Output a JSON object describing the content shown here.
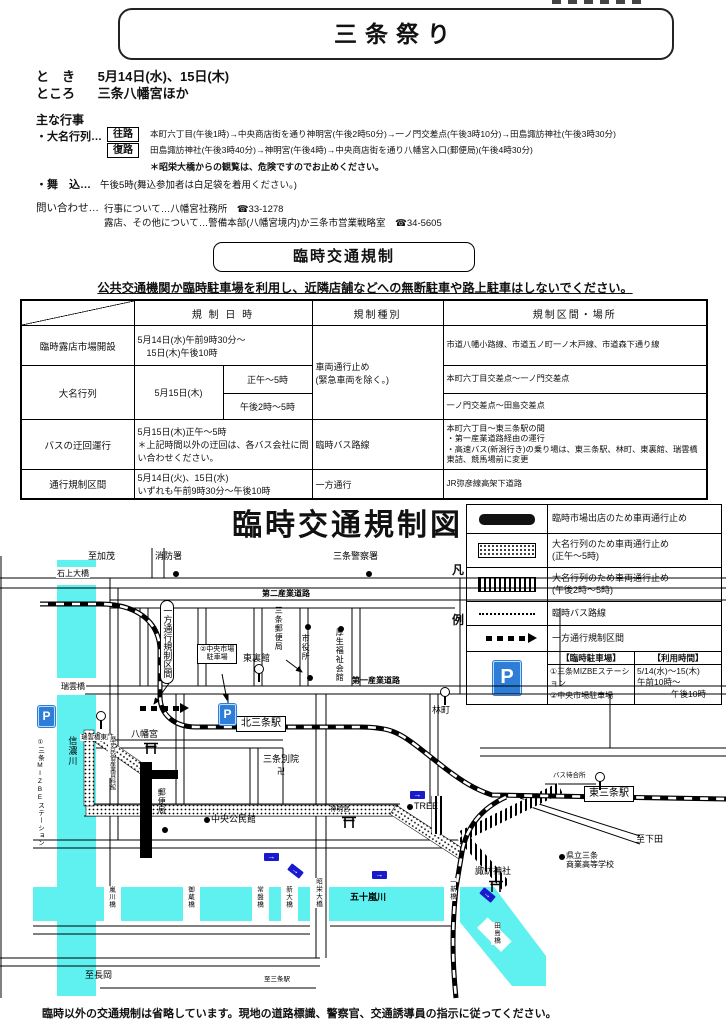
{
  "header": {
    "title": "三条祭り",
    "when_label": "と　き",
    "when": "5月14日(水)、15日(木)",
    "where_label": "ところ",
    "where": "三条八幡宮ほか"
  },
  "events": {
    "heading": "主な行事",
    "daimyo_label": "・大名行列…",
    "outbound_tag": "往路",
    "outbound": "本町六丁目(午後1時)→中央商店街を通り神明宮(午後2時50分)→一ノ門交差点(午後3時10分)→田島諏訪神社(午後3時30分)",
    "return_tag": "復路",
    "return": "田島諏訪神社(午後3時40分)→神明宮(午後4時)→中央商店街を通り八幡宮入口(郵便局)(午後4時30分)",
    "note": "＊昭栄大橋からの観覧は、危険ですのでお止めください。",
    "maikomi_label": "・舞　込…",
    "maikomi": "午後5時(舞込参加者は白足袋を着用ください。)",
    "contact_label": "問い合わせ…",
    "contact1": "行事について…八幡宮社務所　☎33-1278",
    "contact2": "露店、その他について…警備本部(八幡宮境内)か三条市営業戦略室　☎34-5605"
  },
  "regulation": {
    "heading": "臨時交通規制",
    "notice": "公共交通機関か臨時駐車場を利用し、近隣店舗などへの無断駐車や路上駐車はしないでください。",
    "table": {
      "col_datetime": "規 制 日 時",
      "col_type": "規制種別",
      "col_area": "規制区間・場所",
      "rows": {
        "market": {
          "name": "臨時露店市場開設",
          "datetime": "5月14日(水)午前9時30分～\n　15日(木)午後10時",
          "type": "車両通行止め\n(緊急車両を除く。)",
          "area": "市道八幡小路線、市道五ノ町一ノ木戸線、市道森下通り線"
        },
        "parade": {
          "name": "大名行列",
          "date": "5月15日(木)",
          "time1": "正午～5時",
          "area1": "本町六丁目交差点～一ノ門交差点",
          "time2": "午後2時～5時",
          "area2": "一ノ門交差点～田島交差点"
        },
        "bus": {
          "name": "バスの迂回運行",
          "datetime": "5月15日(木)正午～5時\n＊上記時間以外の迂回は、各バス会社に問い合わせください。",
          "type": "臨時バス路線",
          "area": "本町六丁目～東三条駅の間\n・第一産業道路経由の運行\n・高速バス(新潟行き)の乗り場は、東三条駅、林町、東裏館、瑞雲橋東詰、競馬場前に変更"
        },
        "oneway": {
          "name": "通行規制区間",
          "datetime": "5月14日(火)、15日(水)\nいずれも午前9時30分～午後10時",
          "type": "一方通行",
          "area": "JR弥彦線高架下道路"
        }
      }
    }
  },
  "map": {
    "title": "臨時交通規制図",
    "note": "臨時以外の交通規制は省略しています。現地の道路標識、警察官、交通誘導員の指示に従ってください。",
    "legend": {
      "caption_top": "凡",
      "caption_bottom": "例",
      "items": [
        {
          "swatch": "solid",
          "text": "臨時市場出店のため車両通行止め"
        },
        {
          "swatch": "dots",
          "text": "大名行列のため車両通行止め\n(正午～5時)"
        },
        {
          "swatch": "stripes",
          "text": "大名行列のため車両通行止め\n(午後2時～5時)"
        },
        {
          "swatch": "dotline",
          "text": "臨時バス路線"
        },
        {
          "swatch": "dash",
          "text": "一方通行規制区間"
        }
      ],
      "parking": {
        "icon": "P",
        "col1_header": "【臨時駐車場】",
        "col2_header": "【利用時間】",
        "col1_lines": "①三条MIZBEステーション\n②中央市場駐車場",
        "col2_lines": "5/14(水)～15(木)\n午前10時～\n　　　　午後10時"
      }
    },
    "labels": [
      {
        "t": "至加茂",
        "x": 88,
        "y": 3
      },
      {
        "t": "消防署",
        "x": 155,
        "y": 3
      },
      {
        "t": "三条警察署",
        "x": 333,
        "y": 3
      },
      {
        "t": "石上大橋",
        "x": 56,
        "y": 21,
        "c": "wbg sm"
      },
      {
        "t": "第二産業道路",
        "x": 262,
        "y": 41,
        "c": "sm b"
      },
      {
        "t": "第一産業道路",
        "x": 352,
        "y": 128,
        "c": "sm b"
      },
      {
        "t": "一方通行規制区間",
        "x": 160,
        "y": 52,
        "c": "vround"
      },
      {
        "t": "三条郵便局",
        "x": 274,
        "y": 58,
        "c": "v sm"
      },
      {
        "t": "市役所",
        "x": 301,
        "y": 86,
        "c": "v sm"
      },
      {
        "t": "厚生福祉会館",
        "x": 335,
        "y": 80,
        "c": "v sm"
      },
      {
        "t": "②中央市場\n駐車場",
        "x": 197,
        "y": 96,
        "c": "boxsm"
      },
      {
        "t": "東裏館",
        "x": 243,
        "y": 105
      },
      {
        "t": "林町",
        "x": 432,
        "y": 157
      },
      {
        "t": "瑞雲橋",
        "x": 60,
        "y": 134,
        "c": "wbg sm"
      },
      {
        "t": "瑞雲橋東詰",
        "x": 80,
        "y": 186,
        "c": "tiny wbg"
      },
      {
        "t": "八幡宮",
        "x": 131,
        "y": 181
      },
      {
        "t": "歴史民俗産業資料館",
        "x": 108,
        "y": 188,
        "c": "vtiny"
      },
      {
        "t": "北三条駅",
        "x": 236,
        "y": 168,
        "c": "box"
      },
      {
        "t": "三条別院",
        "x": 263,
        "y": 206
      },
      {
        "t": "卍",
        "x": 277,
        "y": 219,
        "c": "sm"
      },
      {
        "t": "郵便局",
        "x": 157,
        "y": 240,
        "c": "v sm"
      },
      {
        "t": "中央公民館",
        "x": 211,
        "y": 266
      },
      {
        "t": "TREE",
        "x": 414,
        "y": 253
      },
      {
        "t": "神明宮",
        "x": 330,
        "y": 258,
        "c": "tiny"
      },
      {
        "t": "バス待合所",
        "x": 553,
        "y": 224,
        "c": "tiny"
      },
      {
        "t": "東三条駅",
        "x": 584,
        "y": 238,
        "c": "box"
      },
      {
        "t": "至下田",
        "x": 636,
        "y": 286
      },
      {
        "t": "県立三条\n商業高等学校",
        "x": 566,
        "y": 303,
        "c": "sm"
      },
      {
        "t": "諏訪神社",
        "x": 475,
        "y": 318
      },
      {
        "t": "一新橋",
        "x": 447,
        "y": 330,
        "c": "v tiny wbg"
      },
      {
        "t": "田島橋",
        "x": 491,
        "y": 374,
        "c": "v tiny wbg"
      },
      {
        "t": "嵐川橋",
        "x": 106,
        "y": 338,
        "c": "v tiny wbg"
      },
      {
        "t": "御蔵橋",
        "x": 185,
        "y": 338,
        "c": "v tiny wbg"
      },
      {
        "t": "常盤橋",
        "x": 254,
        "y": 338,
        "c": "v tiny wbg"
      },
      {
        "t": "新大橋",
        "x": 283,
        "y": 338,
        "c": "v tiny wbg"
      },
      {
        "t": "昭栄大橋",
        "x": 313,
        "y": 330,
        "c": "v tiny wbg"
      },
      {
        "t": "五十嵐川",
        "x": 350,
        "y": 344,
        "c": "b"
      },
      {
        "t": "信濃川",
        "x": 67,
        "y": 188,
        "c": "v"
      },
      {
        "t": "①三条MIZBEステーション",
        "x": 36,
        "y": 190,
        "c": "v tiny"
      },
      {
        "t": "至長岡",
        "x": 85,
        "y": 422
      },
      {
        "t": "至三条駅",
        "x": 264,
        "y": 428,
        "c": "tiny"
      }
    ],
    "markers": [
      {
        "type": "dot",
        "x": 173,
        "y": 23
      },
      {
        "type": "dot",
        "x": 366,
        "y": 23
      },
      {
        "type": "dot",
        "x": 305,
        "y": 76
      },
      {
        "type": "dot",
        "x": 307,
        "y": 127
      },
      {
        "type": "dot",
        "x": 338,
        "y": 78
      },
      {
        "type": "dot",
        "x": 162,
        "y": 279
      },
      {
        "type": "dot",
        "x": 204,
        "y": 269
      },
      {
        "type": "dot",
        "x": 407,
        "y": 256
      },
      {
        "type": "dot",
        "x": 559,
        "y": 306
      },
      {
        "type": "busstop",
        "x": 254,
        "y": 116
      },
      {
        "type": "busstop",
        "x": 440,
        "y": 139
      },
      {
        "type": "busstop",
        "x": 96,
        "y": 163
      },
      {
        "type": "busstop",
        "x": 595,
        "y": 224
      },
      {
        "type": "torii",
        "x": 143,
        "y": 193
      },
      {
        "type": "torii",
        "x": 488,
        "y": 331
      },
      {
        "type": "torii",
        "x": 341,
        "y": 267
      },
      {
        "type": "parking",
        "x": 38,
        "y": 158
      },
      {
        "type": "parking",
        "x": 219,
        "y": 156
      },
      {
        "type": "bluearrow",
        "x": 264,
        "y": 305,
        "r": 0
      },
      {
        "type": "bluearrow",
        "x": 288,
        "y": 319,
        "r": 38
      },
      {
        "type": "bluearrow",
        "x": 372,
        "y": 323,
        "r": 0
      },
      {
        "type": "bluearrow",
        "x": 410,
        "y": 243,
        "r": 0
      },
      {
        "type": "bluearrow",
        "x": 480,
        "y": 343,
        "r": 40
      },
      {
        "type": "dasharrow",
        "x": 140,
        "y": 158
      }
    ]
  }
}
